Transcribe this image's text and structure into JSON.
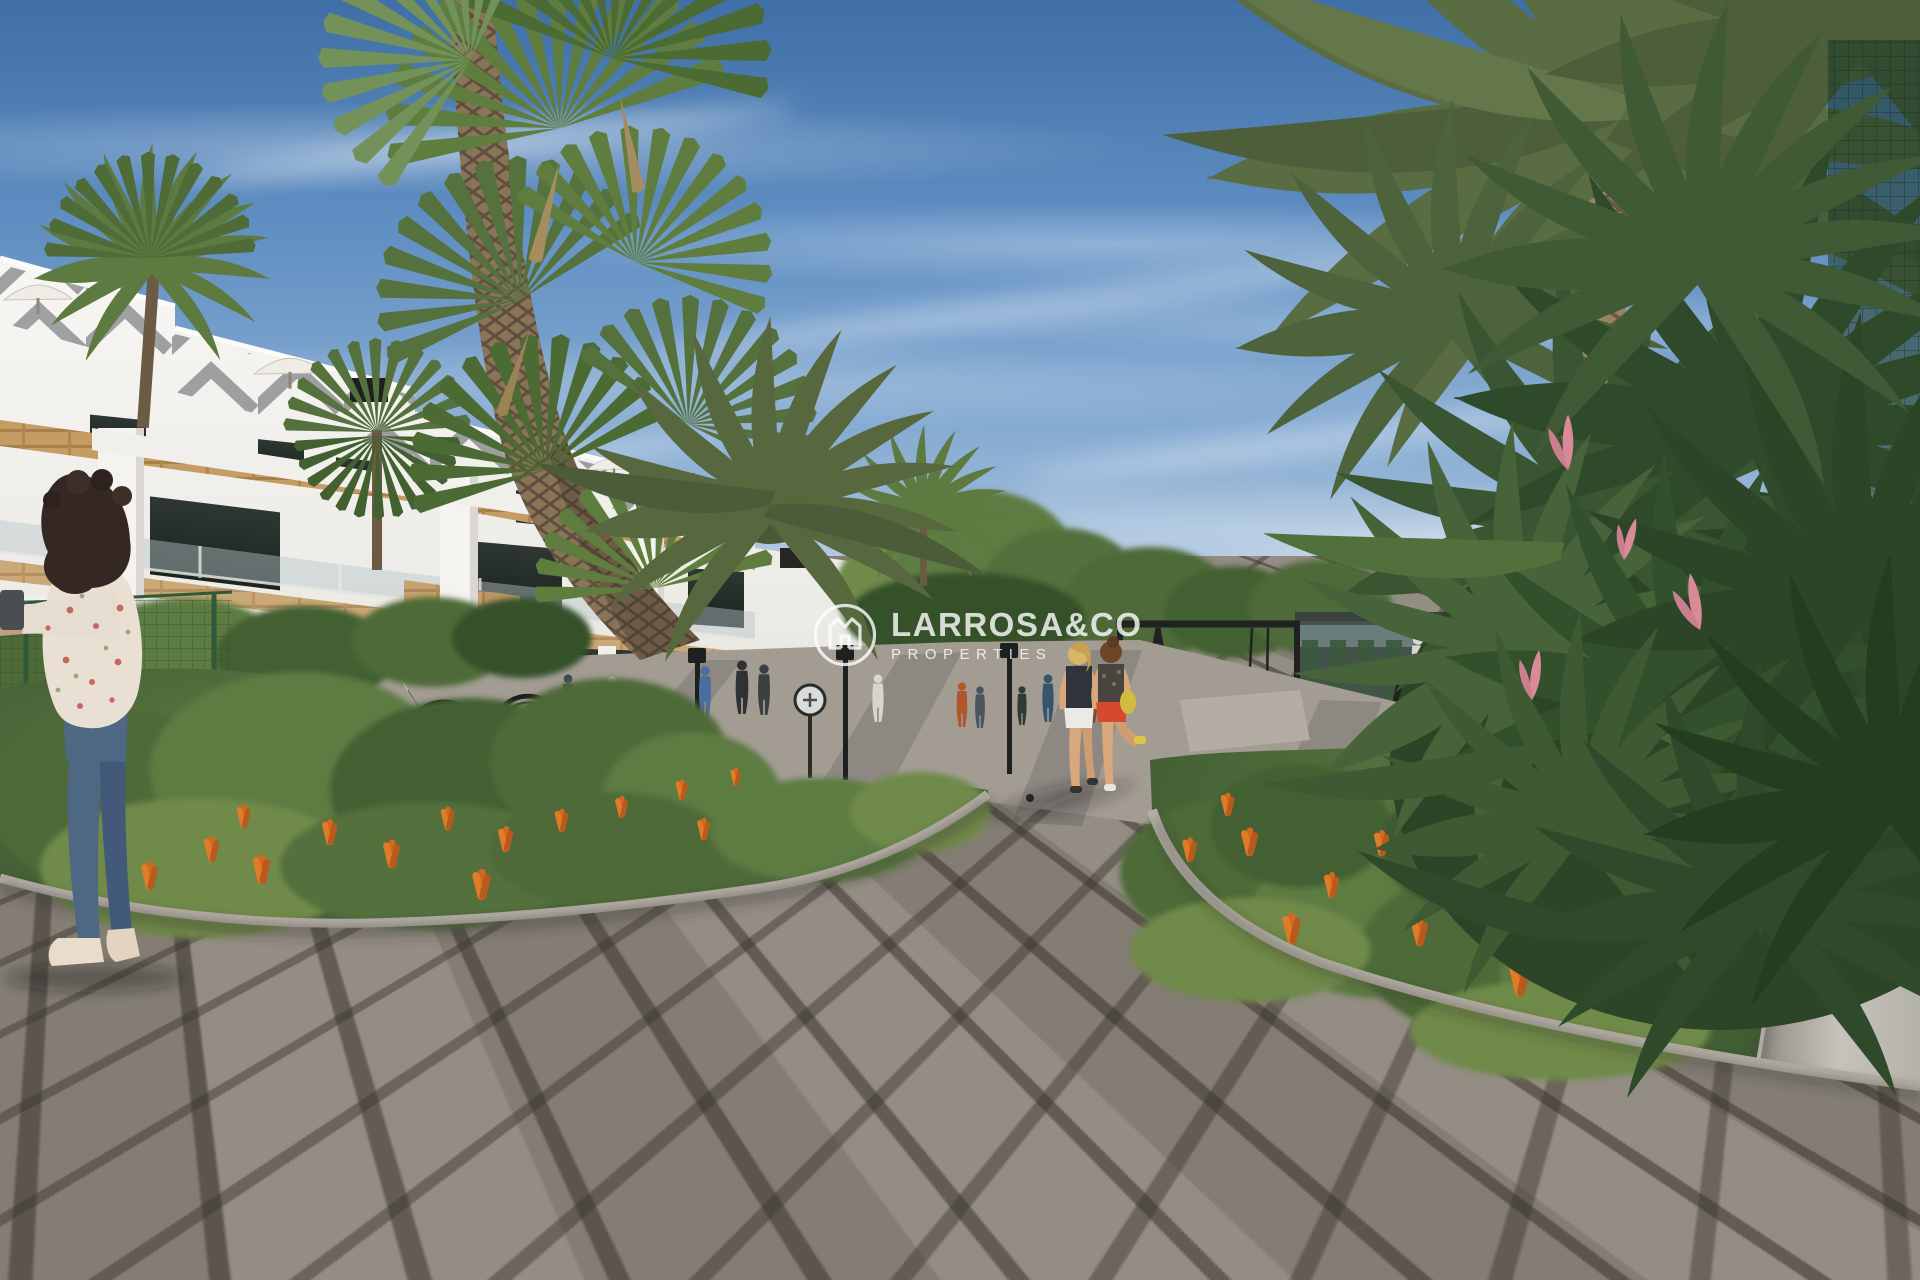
{
  "watermark": {
    "brand": "LARROSA&CO",
    "tagline": "PROPERTIES",
    "logo_icon": "house-monogram-in-circle",
    "color": "#ffffff",
    "opacity": 0.8
  },
  "scene": {
    "type": "architectural-render",
    "palette": {
      "sky_top": "#3f6fa6",
      "sky_mid": "#86abd2",
      "sky_horizon": "#c6d7e5",
      "building_white": "#f2f1ed",
      "wood_accent": "#c59c63",
      "foliage_dark": "#31492b",
      "foliage_mid": "#55713d",
      "foliage_light": "#7b9653",
      "flower_orange": "#d2691f",
      "flower_pink": "#d98a96",
      "paving": "#8d867c",
      "paving_joint": "#5f5952",
      "curb": "#b6b0a7",
      "trunk_brown": "#8a7458",
      "metal_black": "#23231f",
      "red_shorts": "#d6492e",
      "denim_blue": "#4e6883"
    }
  }
}
